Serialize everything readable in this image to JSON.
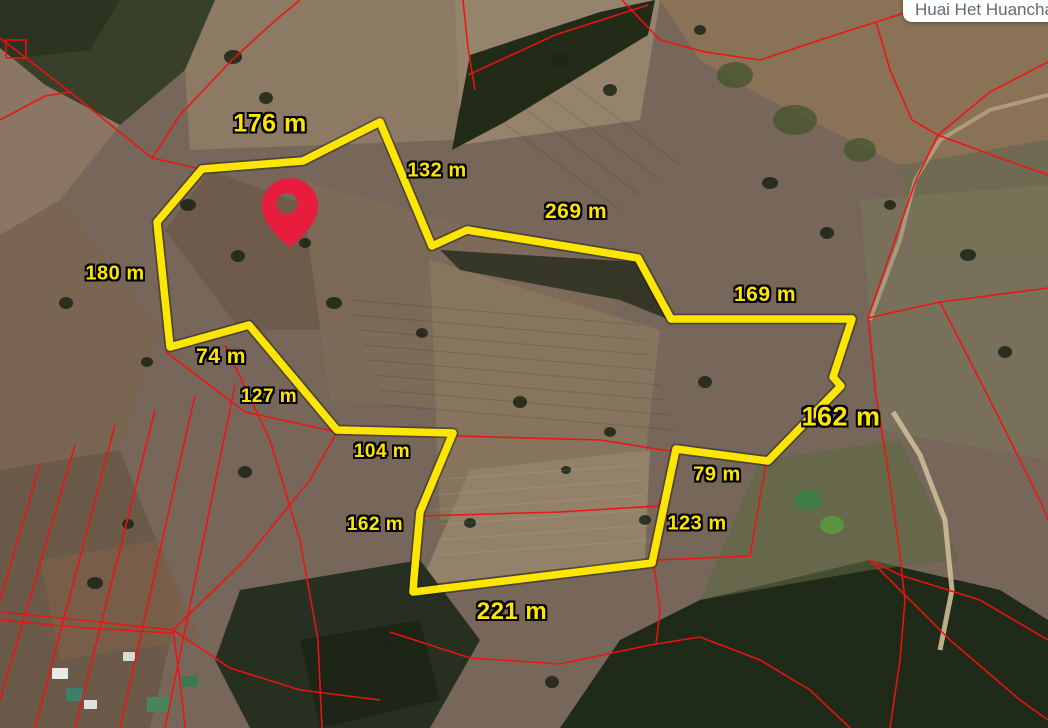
{
  "map": {
    "view": "satellite",
    "place_label": "Huai Het Huanchan",
    "marker": {
      "name": "location-pin"
    },
    "parcel": {
      "unit": "m",
      "edge_lengths_m": [
        176,
        132,
        269,
        169,
        162,
        79,
        123,
        221,
        162,
        104,
        127,
        74,
        180
      ]
    },
    "labels": [
      {
        "text": "176 m",
        "x": 270,
        "y": 124,
        "size": 25
      },
      {
        "text": "132 m",
        "x": 437,
        "y": 171,
        "size": 20
      },
      {
        "text": "269 m",
        "x": 576,
        "y": 212,
        "size": 21
      },
      {
        "text": "169 m",
        "x": 765,
        "y": 295,
        "size": 21
      },
      {
        "text": "180 m",
        "x": 115,
        "y": 274,
        "size": 20
      },
      {
        "text": "74 m",
        "x": 221,
        "y": 357,
        "size": 21
      },
      {
        "text": "127 m",
        "x": 269,
        "y": 397,
        "size": 19
      },
      {
        "text": "104 m",
        "x": 382,
        "y": 452,
        "size": 19
      },
      {
        "text": "162 m",
        "x": 375,
        "y": 525,
        "size": 19
      },
      {
        "text": "221 m",
        "x": 512,
        "y": 612,
        "size": 24
      },
      {
        "text": "79 m",
        "x": 717,
        "y": 475,
        "size": 20
      },
      {
        "text": "123 m",
        "x": 697,
        "y": 524,
        "size": 20
      },
      {
        "text": "162 m",
        "x": 841,
        "y": 417,
        "size": 27
      }
    ],
    "colors": {
      "parcel_outline": "#FFE600",
      "parcel_shadow": "#1A1A1A",
      "cadastral_line": "#F31111",
      "marker_fill": "#E81C3C",
      "label_text": "#FFE600",
      "label_outline": "#000000",
      "place_text": "#5E6B73",
      "place_box": "#FFFFFF"
    }
  }
}
